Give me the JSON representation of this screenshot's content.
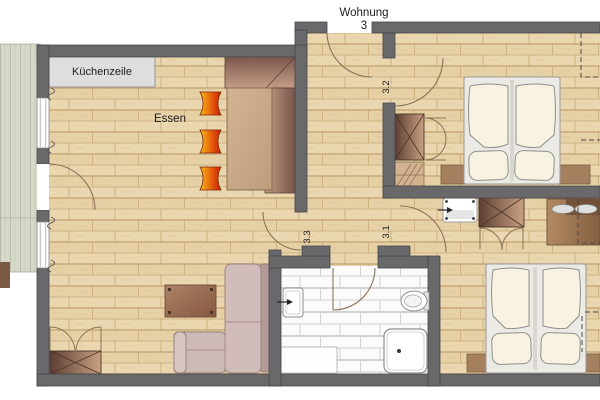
{
  "plan": {
    "title_line1": "Wohnung",
    "title_line2": "3",
    "labels": {
      "kitchen_unit": "Küchenzeile",
      "dining": "Essen",
      "door_hall": "3.2",
      "door_living": "3.3",
      "door_bedroom": "3.1"
    },
    "colors": {
      "wall": "#69696b",
      "wood_floor": "#ead7af",
      "floor_joint": "#c9a878",
      "bath_tile": "#fbfbfb",
      "tile_joint": "#cccccc",
      "balcony_deck": "#d6d9c7",
      "stool_orange": "#e8650c",
      "furniture_brown": "#8a6344",
      "sofa_mauve": "#cfbab6",
      "bedding_cream": "#f7f3e0",
      "door_arc": "#8a7355"
    },
    "fixtures": [
      "balcony-deck",
      "kitchen-unit",
      "corner-bench",
      "dining-table",
      "bar-stool",
      "bar-stool",
      "bar-stool",
      "coffee-table",
      "corner-sofa",
      "wardrobe",
      "wardrobe",
      "wardrobe",
      "shelf",
      "double-bed",
      "double-bed",
      "sideboard",
      "sideboard",
      "washbasin",
      "washbasin",
      "toilet",
      "shower",
      "bath-cabinet",
      "desk"
    ]
  }
}
